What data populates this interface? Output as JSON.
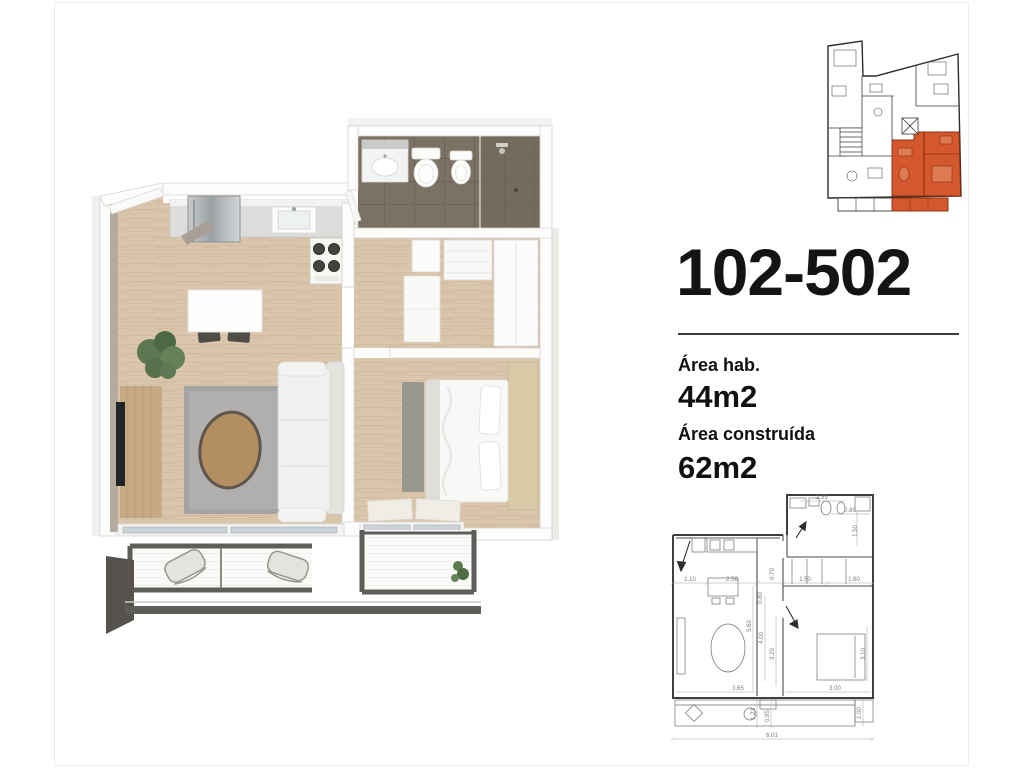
{
  "unit": {
    "number": "102-502",
    "areas": [
      {
        "label": "Área hab.",
        "value": "44m2"
      },
      {
        "label": "Área construída",
        "value": "62m2"
      }
    ]
  },
  "key_plan": {
    "highlight_color": "#d4582d"
  },
  "colors": {
    "wood_floor": "#d9c5ab",
    "bathroom_floor": "#7b7164",
    "railing": "#5d5d5a",
    "line_dark": "#3f3f3f"
  },
  "tech_plan": {
    "dims": {
      "top": "2.89",
      "top_right": "0.80",
      "right_upper": "1.50",
      "row_1": "1.10",
      "row_2": "2.56",
      "row_3": "1.50",
      "row_4": "1.60",
      "corridor_a": "0.80",
      "corridor_b": "0.70",
      "living_depth": "5.60",
      "corridor_c": "4.00",
      "corridor_d": "3.20",
      "bedroom_depth": "3.10",
      "living_width": "3.65",
      "bedroom_width": "3.00",
      "balcony_a": "1.23",
      "balcony_b": "0.95",
      "balcony_right": "1.00",
      "total_width": "6.01"
    }
  }
}
